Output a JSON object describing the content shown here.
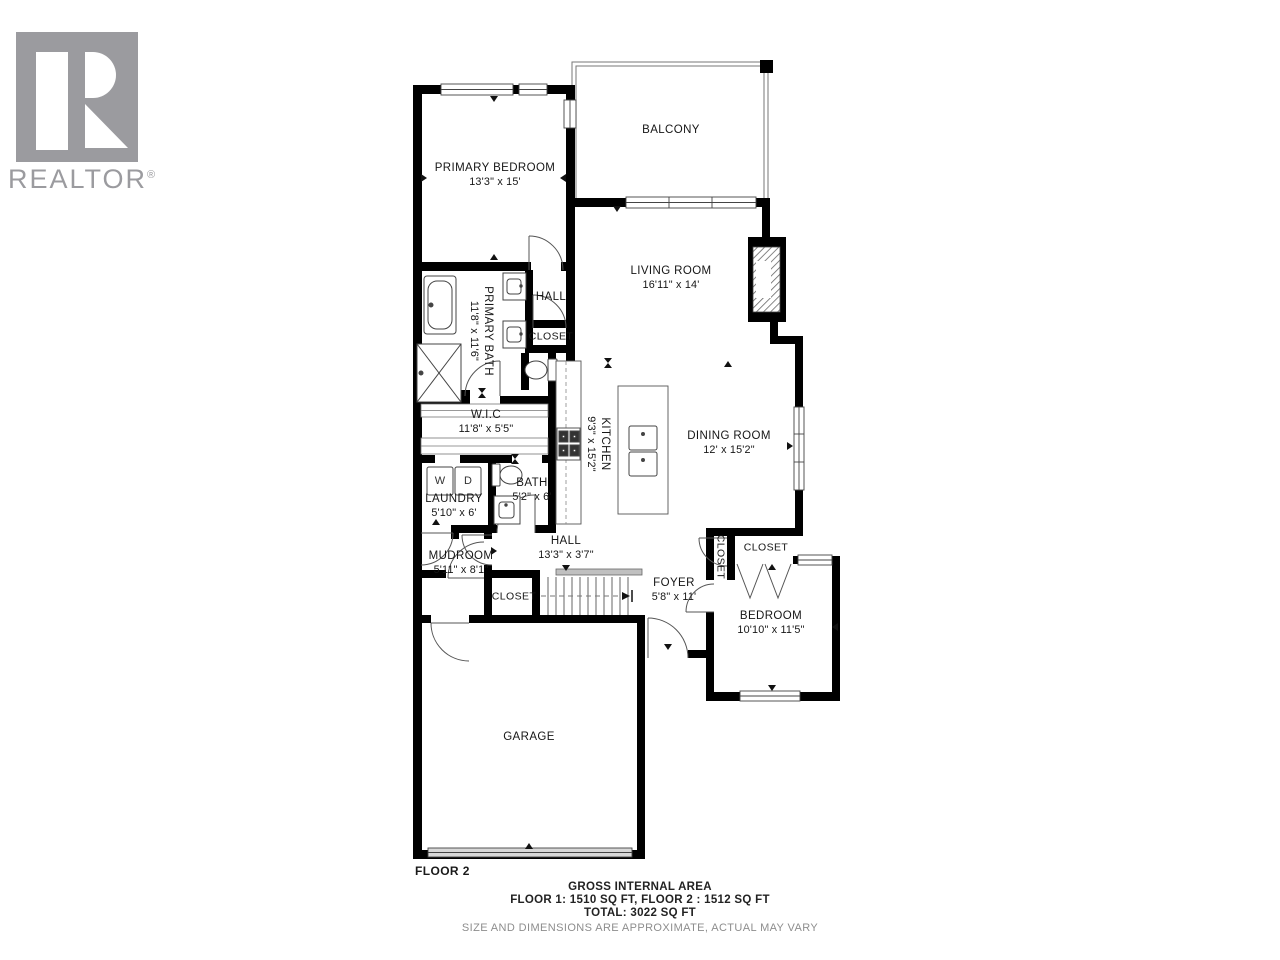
{
  "logo": {
    "brand": "REALTOR",
    "registered": "®"
  },
  "floor_label": "FLOOR 2",
  "rooms": {
    "balcony": {
      "label": "BALCONY",
      "dims": ""
    },
    "primary_bedroom": {
      "label": "PRIMARY BEDROOM",
      "dims": "13'3\" x 15'"
    },
    "living_room": {
      "label": "LIVING ROOM",
      "dims": "16'11\" x 14'"
    },
    "primary_bath": {
      "label": "PRIMARY BATH",
      "dims": "11'8\" x 11'6\""
    },
    "hall_upper": {
      "label": "HALL",
      "dims": ""
    },
    "closet_upper": {
      "label": "CLOSET",
      "dims": ""
    },
    "wic": {
      "label": "W.I.C",
      "dims": "11'8\" x 5'5\""
    },
    "kitchen": {
      "label": "KITCHEN",
      "dims": "9'3\" x 15'2\""
    },
    "dining_room": {
      "label": "DINING ROOM",
      "dims": "12' x 15'2\""
    },
    "laundry": {
      "label": "LAUNDRY",
      "dims": "5'10\" x 6'"
    },
    "bath": {
      "label": "BATH",
      "dims": "5'2\" x 6'"
    },
    "mudroom": {
      "label": "MUDROOM",
      "dims": "5'11\" x 8'1\""
    },
    "hall_lower": {
      "label": "HALL",
      "dims": "13'3\" x 3'7\""
    },
    "closet_mudroom": {
      "label": "CLOSET",
      "dims": ""
    },
    "foyer": {
      "label": "FOYER",
      "dims": "5'8\" x 11'"
    },
    "closet_foyer": {
      "label": "CLOSET",
      "dims": ""
    },
    "closet_bedroom": {
      "label": "CLOSET",
      "dims": ""
    },
    "bedroom": {
      "label": "BEDROOM",
      "dims": "10'10\" x 11'5\""
    },
    "garage": {
      "label": "GARAGE",
      "dims": ""
    }
  },
  "appliances": {
    "washer": "W",
    "dryer": "D"
  },
  "footer": {
    "title": "GROSS INTERNAL AREA",
    "line1": "FLOOR 1: 1510 SQ FT,  FLOOR 2 : 1512 SQ FT",
    "line2": "TOTAL: 3022 SQ FT",
    "disclaimer": "SIZE AND DIMENSIONS ARE APPROXIMATE, ACTUAL MAY VARY"
  },
  "colors": {
    "wall": "#000000",
    "thin_line": "#555555",
    "label_text": "#161616",
    "muted_text": "#8d8d8d",
    "logo_gray": "#9b9b9f"
  }
}
